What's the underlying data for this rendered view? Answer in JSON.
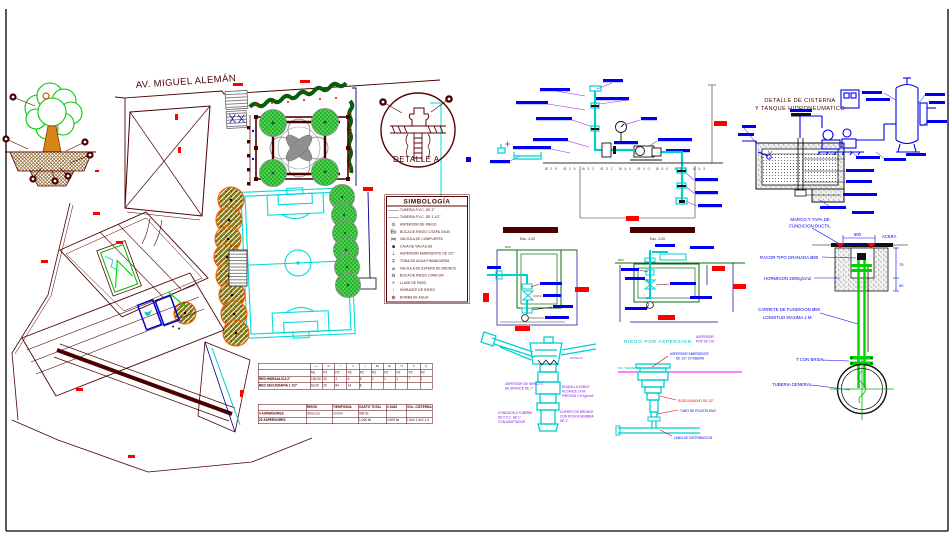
{
  "colors": {
    "maroon": "#4a0000",
    "blue": "#0000ee",
    "cyan": "#00dcdc",
    "green": "#00c800",
    "olive": "#7a7a10",
    "orange": "#ff5a00",
    "red": "#ff0000",
    "magenta": "#ff00ff",
    "purple": "#8a20d0",
    "dark_green": "#0a5c0a"
  },
  "plan": {
    "street": "AV. MIGUEL ALEMÁN"
  },
  "detail_a": {
    "label": "DETALLE A"
  },
  "legend": {
    "title": "SIMBOLOGÍA",
    "items": [
      {
        "icon": "pipe-2in-line",
        "glyph": "——",
        "label": "TUBERIA P.V.C. DE 2\""
      },
      {
        "icon": "pipe-15in-line",
        "glyph": "——",
        "label": "TUBERIA P.V.C. DE 1 1/2\""
      },
      {
        "icon": "sprinkler-circle",
        "glyph": "⊙",
        "label": "ASPERSOR DE RIEGO"
      },
      {
        "icon": "boca-riego",
        "glyph": "Bo",
        "label": "BOCA DE RIEGO C/TAPA 30x30"
      },
      {
        "icon": "gate-valve",
        "glyph": "⋈",
        "label": "VALVULA DE COMPUERTA"
      },
      {
        "icon": "valve-box",
        "glyph": "■",
        "label": "CAJA DE VALVULAS"
      },
      {
        "icon": "popup-sprinkler",
        "glyph": "⊥",
        "label": "ASPERSOR EMERGENTE DE 1/2\""
      },
      {
        "icon": "hose-tap",
        "glyph": "∓",
        "label": "TOMA DE AGUA P/MANGUERA"
      },
      {
        "icon": "ball-valve",
        "glyph": "⌀",
        "label": "VALVULA DE ESFERA DE BRONCE"
      },
      {
        "icon": "boca-racor",
        "glyph": "⊖",
        "label": "BOCA DE RIEGO C/RACOR"
      },
      {
        "icon": "stop-cock",
        "glyph": "×",
        "label": "LLAVE DE PASO"
      },
      {
        "icon": "hydrant",
        "glyph": "↑",
        "label": "HIDRANTE DE RIEGO"
      },
      {
        "icon": "water-pump",
        "glyph": "⊗",
        "label": "BOMBA DE AGUA"
      }
    ]
  },
  "quantities_table": {
    "icons": [
      "—",
      "⊙",
      "⌐",
      "□",
      "⊥",
      "⋈",
      "⊞",
      "⊓",
      "∓",
      "∥"
    ],
    "units": [
      "ML",
      "PZ",
      "PZ",
      "PZ",
      "PZ",
      "PZ",
      "PZ",
      "PZ",
      "PZ",
      "PZ"
    ],
    "rows": [
      {
        "label": "RED HIDRAULICA 2\"",
        "values": [
          "193.50",
          "20",
          "2",
          "8",
          "8",
          "1",
          "1",
          "1",
          "7",
          "1"
        ]
      },
      {
        "label": "RED SECUNDARIA 1 1/2\"",
        "values": [
          "63.00",
          "20",
          "84",
          "14",
          "8",
          "",
          "",
          "",
          "",
          ""
        ]
      }
    ]
  },
  "consumption_table": {
    "headers": [
      "",
      "RIEGO",
      "TIEMPO/DIA",
      "GASTO TOTAL",
      "# DIAS",
      "VOL. CISTERNA"
    ],
    "rows": [
      [
        "4 ASPERSORES",
        "30 l/s c/u",
        "10 min",
        "500 lts",
        "",
        ""
      ],
      [
        "20 ASPERSORES",
        "",
        "",
        "1,000 lts",
        "2,500 lts",
        "1.5x2 1.5x2 1.5"
      ]
    ]
  },
  "schematic": {
    "pipe_sizes": "Ø25 Ø25 Ø32 Ø32 Ø40 Ø40 Ø50 Ø50 Ø63"
  },
  "sections": {
    "a_caption": "Esc. 1:20",
    "b_caption": "Esc. 1:20",
    "a_dia": "Ø50",
    "b_dia": "Ø50"
  },
  "impact": {
    "a1": "ASPERSOR DE IMPACTO",
    "a2": "DE BRONCE DE 1\"",
    "b1": "CONEXION A TUBERIA",
    "b2": "DE P.V.C. DE 1\"",
    "b3": "CON ADAPTADOR",
    "c1": "BOQUILLA DOBLE",
    "c2": "ALCANCE 14 M.",
    "c3": "PRESION 2.5 Kg/cm2",
    "d1": "CUERPO DE BRONCE",
    "d2": "CON ROSCA HEMBRA",
    "d3": "DE 1\"",
    "e": "GATILLO"
  },
  "popup": {
    "title": "RIEGO POR ASPERSION",
    "ground": "NIV. TERRENO",
    "tag1": "ASPERSOR",
    "tag2": "POP-UP 1/2\"",
    "l1a": "ASPERSOR EMERGENTE",
    "l1b": "DE 1/2\" C/TOBERA",
    "l2": "ROSCA MACHO DE 1/2\"",
    "l3": "TUBO DE POLIETILENO",
    "l4": "LINEA DE DISTRIBUCION"
  },
  "cistern": {
    "t1": "DETALLE DE CISTERNA",
    "t2": "Y TANQUE HIDRONEUMATICO"
  },
  "hydrant": {
    "m1": "MARCO Y TAPA DE",
    "m2": "FUNDICION DUCTIL",
    "dim600": "600",
    "acera": "ACERA",
    "racor": "RACOR TIPO GRANADA Ø80",
    "hormigon": "HORMIGON 200Kg/cm2",
    "carrete1": "CARRETE DE FUNDICION Ø80",
    "carrete2": "LONGITUD MAXIMA 1 M.",
    "tbrida": "T CON BRIDA",
    "tuberia": "TUBERIA GENERAL",
    "d75": "75",
    "d50": "50"
  }
}
